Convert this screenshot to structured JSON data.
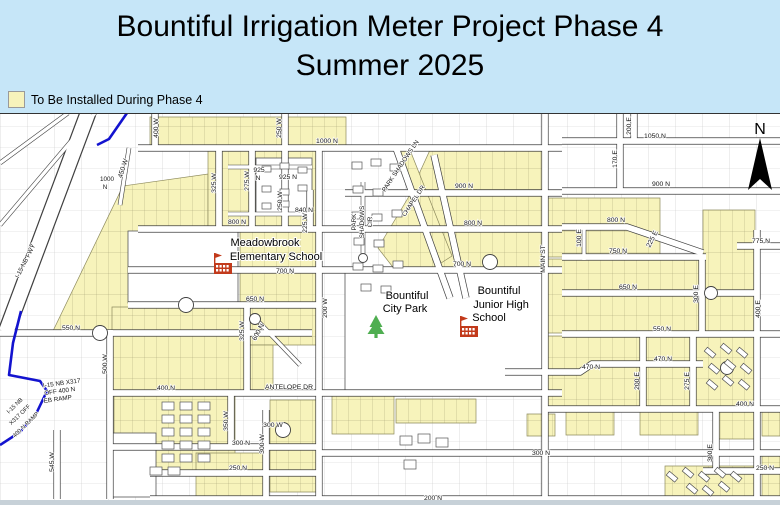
{
  "header": {
    "title_line1": "Bountiful Irrigation Meter Project Phase 4",
    "title_line2": "Summer 2025",
    "legend_label": "To Be Installed During Phase 4"
  },
  "map": {
    "compass_label": "N",
    "colors": {
      "highlight": "#f7f3bb",
      "header_bg": "#c6e6f8",
      "ramp_blue": "#1313cf",
      "school_red": "#c23a1b",
      "tree_green": "#4fae51",
      "road_line": "#3f3f3f",
      "grid_line": "#c9c9c9"
    },
    "street_labels": [
      {
        "t": "1000 N",
        "x": 327,
        "y": 143
      },
      {
        "t": "1050 N",
        "x": 655,
        "y": 138
      },
      {
        "t": "900 N",
        "x": 661,
        "y": 186
      },
      {
        "t": "900 N",
        "x": 464,
        "y": 188
      },
      {
        "t": "925 N",
        "x": 288,
        "y": 179
      },
      {
        "t": "925",
        "x": 259,
        "y": 172
      },
      {
        "t": "N",
        "x": 258,
        "y": 180
      },
      {
        "t": "840 N",
        "x": 304,
        "y": 212
      },
      {
        "t": "800 N",
        "x": 237,
        "y": 224
      },
      {
        "t": "800 N",
        "x": 473,
        "y": 225
      },
      {
        "t": "800 N",
        "x": 616,
        "y": 222
      },
      {
        "t": "775 N",
        "x": 761,
        "y": 243
      },
      {
        "t": "750 N",
        "x": 618,
        "y": 253
      },
      {
        "t": "700 N",
        "x": 285,
        "y": 273
      },
      {
        "t": "700 N",
        "x": 462,
        "y": 266
      },
      {
        "t": "650 N",
        "x": 255,
        "y": 301
      },
      {
        "t": "650 N",
        "x": 628,
        "y": 289
      },
      {
        "t": "600 N",
        "x": 260,
        "y": 333,
        "r": -62
      },
      {
        "t": "550 N",
        "x": 71,
        "y": 330
      },
      {
        "t": "550 N",
        "x": 662,
        "y": 331
      },
      {
        "t": "470 N",
        "x": 591,
        "y": 369
      },
      {
        "t": "470 N",
        "x": 663,
        "y": 361
      },
      {
        "t": "400 N",
        "x": 166,
        "y": 390
      },
      {
        "t": "400 N",
        "x": 745,
        "y": 406
      },
      {
        "t": "ANTELOPE DR",
        "x": 289,
        "y": 389
      },
      {
        "t": "300 N",
        "x": 241,
        "y": 445
      },
      {
        "t": "300 N",
        "x": 541,
        "y": 455
      },
      {
        "t": "250 N",
        "x": 238,
        "y": 470
      },
      {
        "t": "250 N",
        "x": 765,
        "y": 470
      },
      {
        "t": "200 N",
        "x": 433,
        "y": 500
      },
      {
        "t": "300 W",
        "x": 273,
        "y": 427
      },
      {
        "t": "I-15 NB X317",
        "x": 62,
        "y": 385,
        "r": -8,
        "s": 6.3
      },
      {
        "t": "OFF 400 N",
        "x": 60,
        "y": 393,
        "r": -8,
        "s": 6.3
      },
      {
        "t": "EB RAMP",
        "x": 58,
        "y": 401,
        "r": -8,
        "s": 6.3
      },
      {
        "t": "I-15 NB",
        "x": 16,
        "y": 407,
        "r": -44,
        "s": 5.8
      },
      {
        "t": "X317 OFF",
        "x": 21,
        "y": 416,
        "r": -44,
        "s": 5.8
      },
      {
        "t": "400 N RAMP",
        "x": 27,
        "y": 426,
        "r": -44,
        "s": 5.8
      },
      {
        "t": "I-15 NB FWY",
        "x": 27,
        "y": 262,
        "r": -63,
        "s": 6.3
      },
      {
        "t": "450 W",
        "x": 125,
        "y": 169,
        "r": -72
      },
      {
        "t": "1000",
        "x": 107,
        "y": 181,
        "s": 6.3
      },
      {
        "t": "N",
        "x": 105,
        "y": 189,
        "s": 6.3
      },
      {
        "t": "400 W",
        "x": 158,
        "y": 128,
        "r": -90
      },
      {
        "t": "250 W",
        "x": 281,
        "y": 128,
        "r": -90
      },
      {
        "t": "325 W",
        "x": 216,
        "y": 183,
        "r": -90
      },
      {
        "t": "275 W",
        "x": 249,
        "y": 181,
        "r": -90
      },
      {
        "t": "250 W",
        "x": 282,
        "y": 201,
        "r": -90
      },
      {
        "t": "225 W",
        "x": 307,
        "y": 223,
        "r": -90
      },
      {
        "t": "200 W",
        "x": 327,
        "y": 308,
        "r": -90
      },
      {
        "t": "325 W",
        "x": 244,
        "y": 331,
        "r": -90
      },
      {
        "t": "500 W",
        "x": 107,
        "y": 364,
        "r": -90
      },
      {
        "t": "545 W",
        "x": 54,
        "y": 462,
        "r": -90
      },
      {
        "t": "350 W",
        "x": 228,
        "y": 421,
        "r": -90
      },
      {
        "t": "300 W",
        "x": 264,
        "y": 444,
        "r": -90
      },
      {
        "t": "MAIN ST",
        "x": 545,
        "y": 259,
        "r": -90
      },
      {
        "t": "100 E",
        "x": 581,
        "y": 238,
        "r": -90
      },
      {
        "t": "170 E",
        "x": 617,
        "y": 159,
        "r": -90
      },
      {
        "t": "200 E",
        "x": 631,
        "y": 126,
        "r": -90
      },
      {
        "t": "200 E",
        "x": 639,
        "y": 381,
        "r": -90
      },
      {
        "t": "275 E",
        "x": 689,
        "y": 381,
        "r": -90
      },
      {
        "t": "300 E",
        "x": 698,
        "y": 294,
        "r": -90
      },
      {
        "t": "300 E",
        "x": 712,
        "y": 453,
        "r": -90
      },
      {
        "t": "400 E",
        "x": 760,
        "y": 309,
        "r": -90
      },
      {
        "t": "PARK",
        "x": 356,
        "y": 222,
        "r": -90,
        "s": 6.3
      },
      {
        "t": "SHADOWS",
        "x": 364,
        "y": 222,
        "r": -90,
        "s": 6.3
      },
      {
        "t": "CIR",
        "x": 372,
        "y": 222,
        "r": -90,
        "s": 6.3
      },
      {
        "t": "PARK SHADOWS LN",
        "x": 402,
        "y": 167,
        "r": -56,
        "s": 6.3
      },
      {
        "t": "CHAPEL DR",
        "x": 415,
        "y": 202,
        "r": -56,
        "s": 6.3
      },
      {
        "t": "225 E",
        "x": 654,
        "y": 240,
        "r": -63
      }
    ],
    "poi_labels": [
      {
        "t": "Meadowbrook",
        "x": 265,
        "y": 246
      },
      {
        "t": "Elementary School",
        "x": 276,
        "y": 260
      },
      {
        "t": "Bountiful",
        "x": 407,
        "y": 299
      },
      {
        "t": "City Park",
        "x": 405,
        "y": 312
      },
      {
        "t": "Bountiful",
        "x": 499,
        "y": 294
      },
      {
        "t": "Junior High",
        "x": 501,
        "y": 308
      },
      {
        "t": "School",
        "x": 489,
        "y": 321
      }
    ]
  }
}
